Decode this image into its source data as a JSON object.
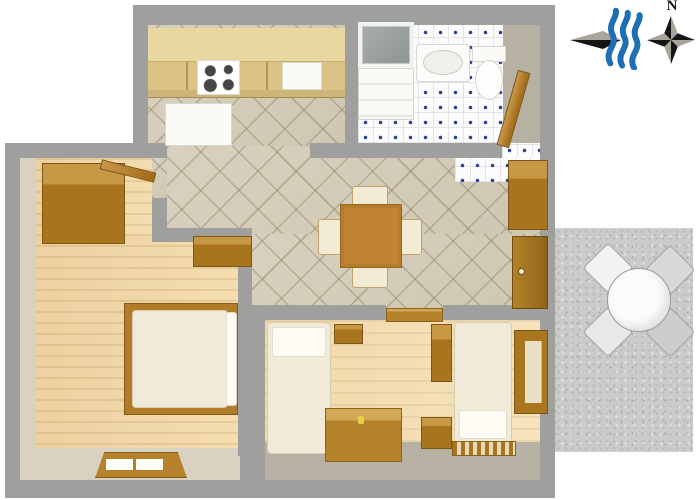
{
  "title": "apartment-floor-plan",
  "compass": {
    "north_label": "N"
  },
  "icons": [
    {
      "name": "sea-direction-arrow-icon",
      "meaning": "arrow pointing toward the sea"
    },
    {
      "name": "sea-waves-icon",
      "meaning": "three blue waves"
    },
    {
      "name": "compass-rose-icon",
      "meaning": "four-point compass rose marked N"
    }
  ],
  "colors": {
    "wall_gray": "#9f9f9d",
    "inner_wall_beige": "#d9d2c2",
    "tile_beige": "#d6cebb",
    "tile_white": "#fcfcfc",
    "tile_dot_blue": "#2b3f94",
    "wood_floor": "#ecd0a0",
    "wood_furniture_dark": "#a8741e",
    "wood_furniture_light": "#c89944",
    "kitchen_counter_tan": "#dbc385",
    "fixture_white": "#fbfaf7",
    "upholstery_cream": "#f2ebd6",
    "terrace_gray": "#cbcbc9",
    "wave_blue": "#1f6fb5",
    "compass_black": "#111111",
    "compass_gray": "#a8a49c"
  },
  "rooms": [
    {
      "id": "kitchen",
      "label": "kitchen with stove, sink and fridge"
    },
    {
      "id": "bathroom",
      "label": "bathroom with shower, washer, sink and toilet"
    },
    {
      "id": "dining-room",
      "label": "dining room with table and four chairs"
    },
    {
      "id": "hallway",
      "label": "entrance hall with cabinet and door"
    },
    {
      "id": "bedroom",
      "label": "bedroom with double bed and wardrobe"
    },
    {
      "id": "living-bedroom",
      "label": "room with two single beds, table and wardrobe"
    },
    {
      "id": "terrace",
      "label": "terrace with round table and four chairs"
    }
  ],
  "plan": {
    "elements": [
      {
        "name": "terrace-floor",
        "kind": "speckle",
        "rect": [
          555,
          228,
          138,
          224
        ]
      },
      {
        "name": "building-top-section",
        "kind": "wall",
        "rect": [
          133,
          5,
          422,
          138
        ]
      },
      {
        "name": "building-main-section",
        "kind": "wall",
        "rect": [
          5,
          143,
          550,
          355
        ]
      },
      {
        "name": "kitchen-floor",
        "kind": "tile-beige",
        "rect": [
          148,
          25,
          197,
          121
        ]
      },
      {
        "name": "bathroom-floor",
        "kind": "tile-white",
        "rect": [
          358,
          25,
          145,
          118
        ]
      },
      {
        "name": "bathroom-right-wall-face",
        "kind": "face2",
        "rect": [
          503,
          25,
          37,
          118
        ]
      },
      {
        "name": "dining-floor-upper",
        "kind": "tile-beige",
        "rect": [
          167,
          146,
          373,
          88
        ]
      },
      {
        "name": "dining-floor-lower",
        "kind": "tile-beige",
        "rect": [
          252,
          234,
          288,
          74
        ]
      },
      {
        "name": "bedroom-floor-upper",
        "kind": "wood-floor",
        "rect": [
          20,
          158,
          132,
          80
        ]
      },
      {
        "name": "bedroom-floor-lower",
        "kind": "wood-floor",
        "rect": [
          20,
          234,
          220,
          216
        ]
      },
      {
        "name": "bedroom-left-wall-face",
        "kind": "face",
        "rect": [
          20,
          158,
          16,
          292
        ]
      },
      {
        "name": "bedroom-bottom-wall-face",
        "kind": "face",
        "rect": [
          20,
          448,
          220,
          32
        ]
      },
      {
        "name": "livingroom-floor",
        "kind": "wood-floor2",
        "rect": [
          265,
          320,
          275,
          122
        ]
      },
      {
        "name": "livingroom-bottom-face",
        "kind": "face2",
        "rect": [
          265,
          442,
          275,
          38
        ]
      },
      {
        "name": "wall-top-left",
        "kind": "wall",
        "rect": [
          5,
          143,
          162,
          15
        ]
      },
      {
        "name": "wall-kitchen-stub",
        "kind": "wall",
        "rect": [
          310,
          143,
          42,
          15
        ]
      },
      {
        "name": "wall-kitchen-bathroom",
        "kind": "wall",
        "rect": [
          345,
          5,
          13,
          140
        ]
      },
      {
        "name": "wall-below-bathroom",
        "kind": "wall",
        "rect": [
          345,
          143,
          157,
          15
        ]
      },
      {
        "name": "hall-doorway-tiles",
        "kind": "tile-white",
        "rect": [
          502,
          143,
          38,
          17
        ]
      },
      {
        "name": "hall-floor-tiles",
        "kind": "tile-white",
        "rect": [
          455,
          158,
          85,
          24
        ]
      },
      {
        "name": "bedroom-doorway-tiles",
        "kind": "tile-beige",
        "rect": [
          152,
          158,
          15,
          40
        ]
      },
      {
        "name": "wall-bedroom-upper-v",
        "kind": "wall",
        "rect": [
          152,
          198,
          15,
          36
        ]
      },
      {
        "name": "wall-bedroom-jog",
        "kind": "wall",
        "rect": [
          152,
          228,
          100,
          14
        ]
      },
      {
        "name": "wall-bedroom-dining-v",
        "kind": "wall",
        "rect": [
          238,
          242,
          14,
          66
        ]
      },
      {
        "name": "wall-dining-living-left",
        "kind": "wall",
        "rect": [
          238,
          305,
          148,
          15
        ]
      },
      {
        "name": "wall-dining-living-right",
        "kind": "wall",
        "rect": [
          443,
          305,
          97,
          15
        ]
      },
      {
        "name": "wall-bedroom-living-v",
        "kind": "wall",
        "rect": [
          238,
          308,
          27,
          148
        ]
      },
      {
        "name": "doorway-threshold",
        "kind": "wood-mid",
        "rect": [
          386,
          308,
          57,
          14
        ]
      },
      {
        "name": "kitchen-upper-cabinet",
        "kind": "counter-top",
        "rect": [
          148,
          28,
          197,
          34
        ]
      },
      {
        "name": "kitchen-cabinet-front",
        "kind": "counter-front",
        "rect": [
          148,
          62,
          197,
          30
        ]
      },
      {
        "name": "kitchen-counter-edge",
        "kind": "counter-edge",
        "rect": [
          148,
          90,
          197,
          8
        ]
      },
      {
        "name": "stove",
        "kind": "stove",
        "rect": [
          197,
          60,
          43,
          35
        ]
      },
      {
        "name": "kitchen-sink",
        "kind": "appliance",
        "rect": [
          282,
          62,
          40,
          28
        ]
      },
      {
        "name": "refrigerator",
        "kind": "appliance",
        "rect": [
          165,
          103,
          67,
          43
        ]
      },
      {
        "name": "shower",
        "kind": "shower",
        "rect": [
          358,
          22,
          56,
          46
        ]
      },
      {
        "name": "washing-machine",
        "kind": "washer",
        "rect": [
          358,
          68,
          56,
          52
        ]
      },
      {
        "name": "bathroom-sink",
        "kind": "sink",
        "rect": [
          416,
          44,
          54,
          38
        ]
      },
      {
        "name": "toilet-tank",
        "kind": "appliance",
        "rect": [
          472,
          46,
          34,
          16
        ]
      },
      {
        "name": "toilet-bowl",
        "kind": "toilet-bowl",
        "rect": [
          475,
          60,
          28,
          40
        ]
      },
      {
        "name": "bathroom-door",
        "kind": "door-leaf",
        "rect": [
          507,
          70,
          13,
          78
        ],
        "rot": 16
      },
      {
        "name": "hall-cabinet",
        "kind": "wood-dark",
        "rect": [
          508,
          160,
          40,
          70
        ]
      },
      {
        "name": "entrance-door",
        "kind": "entrance-door",
        "rect": [
          512,
          236,
          36,
          73
        ]
      },
      {
        "name": "dining-chair-top",
        "kind": "chair",
        "rect": [
          352,
          186,
          36,
          24
        ]
      },
      {
        "name": "dining-chair-bottom",
        "kind": "chair",
        "rect": [
          352,
          264,
          36,
          24
        ]
      },
      {
        "name": "dining-chair-left",
        "kind": "chair",
        "rect": [
          318,
          219,
          24,
          36
        ]
      },
      {
        "name": "dining-chair-right",
        "kind": "chair",
        "rect": [
          398,
          219,
          24,
          36
        ]
      },
      {
        "name": "dining-table",
        "kind": "table-wood",
        "rect": [
          340,
          204,
          62,
          64
        ]
      },
      {
        "name": "bedroom-nook-cabinet",
        "kind": "wood-dark",
        "rect": [
          193,
          236,
          59,
          31
        ]
      },
      {
        "name": "bedroom-wardrobe",
        "kind": "wood-dark",
        "rect": [
          42,
          163,
          83,
          81
        ]
      },
      {
        "name": "bedroom-door",
        "kind": "door-leaf",
        "rect": [
          100,
          166,
          56,
          10
        ],
        "rot": 14
      },
      {
        "name": "double-bed-frame",
        "kind": "bedframe",
        "rect": [
          124,
          303,
          114,
          112
        ]
      },
      {
        "name": "double-bed-mattress",
        "kind": "bed",
        "rect": [
          132,
          310,
          96,
          98
        ]
      },
      {
        "name": "double-bed-pillow",
        "kind": "pillow",
        "rect": [
          226,
          312,
          11,
          94
        ]
      },
      {
        "name": "bedroom-window",
        "kind": "window-h",
        "rect": [
          95,
          452,
          92,
          26
        ]
      },
      {
        "name": "single-bed-left",
        "kind": "bed",
        "rect": [
          267,
          322,
          64,
          132
        ]
      },
      {
        "name": "single-bed-left-pillow",
        "kind": "pillow",
        "rect": [
          272,
          327,
          54,
          30
        ]
      },
      {
        "name": "living-cabinet-small",
        "kind": "wood-dark",
        "rect": [
          334,
          324,
          29,
          20
        ]
      },
      {
        "name": "living-wardrobe",
        "kind": "wood-dark",
        "rect": [
          431,
          324,
          21,
          58
        ]
      },
      {
        "name": "living-table",
        "kind": "wood-mid",
        "rect": [
          325,
          408,
          77,
          54
        ]
      },
      {
        "name": "candle",
        "kind": "dot",
        "rect": [
          358,
          416,
          6,
          8
        ],
        "color": "#e6d24a"
      },
      {
        "name": "nightstand",
        "kind": "wood-dark",
        "rect": [
          421,
          417,
          31,
          32
        ]
      },
      {
        "name": "single-bed-right",
        "kind": "bed",
        "rect": [
          454,
          322,
          58,
          122
        ]
      },
      {
        "name": "single-bed-right-pillow",
        "kind": "pillow",
        "rect": [
          459,
          410,
          48,
          29
        ]
      },
      {
        "name": "bedside-rug",
        "kind": "mat",
        "rect": [
          452,
          441,
          64,
          15
        ]
      },
      {
        "name": "living-window",
        "kind": "window-v",
        "rect": [
          514,
          330,
          34,
          84
        ]
      },
      {
        "name": "terrace-chair-nw",
        "kind": "terrace-chair",
        "rect": [
          590,
          250,
          36,
          36
        ],
        "rot": 45,
        "color": "#f2f2f0"
      },
      {
        "name": "terrace-chair-ne",
        "kind": "terrace-chair",
        "rect": [
          652,
          252,
          36,
          36
        ],
        "rot": 45,
        "color": "#d8d8d6"
      },
      {
        "name": "terrace-chair-sw",
        "kind": "terrace-chair",
        "rect": [
          590,
          314,
          36,
          36
        ],
        "rot": 45,
        "color": "#e9e9e7"
      },
      {
        "name": "terrace-chair-se",
        "kind": "terrace-chair",
        "rect": [
          652,
          314,
          36,
          36
        ],
        "rot": 45,
        "color": "#cdcdcb"
      },
      {
        "name": "terrace-table",
        "kind": "terrace-table",
        "rect": [
          607,
          268,
          64,
          64
        ]
      }
    ]
  }
}
